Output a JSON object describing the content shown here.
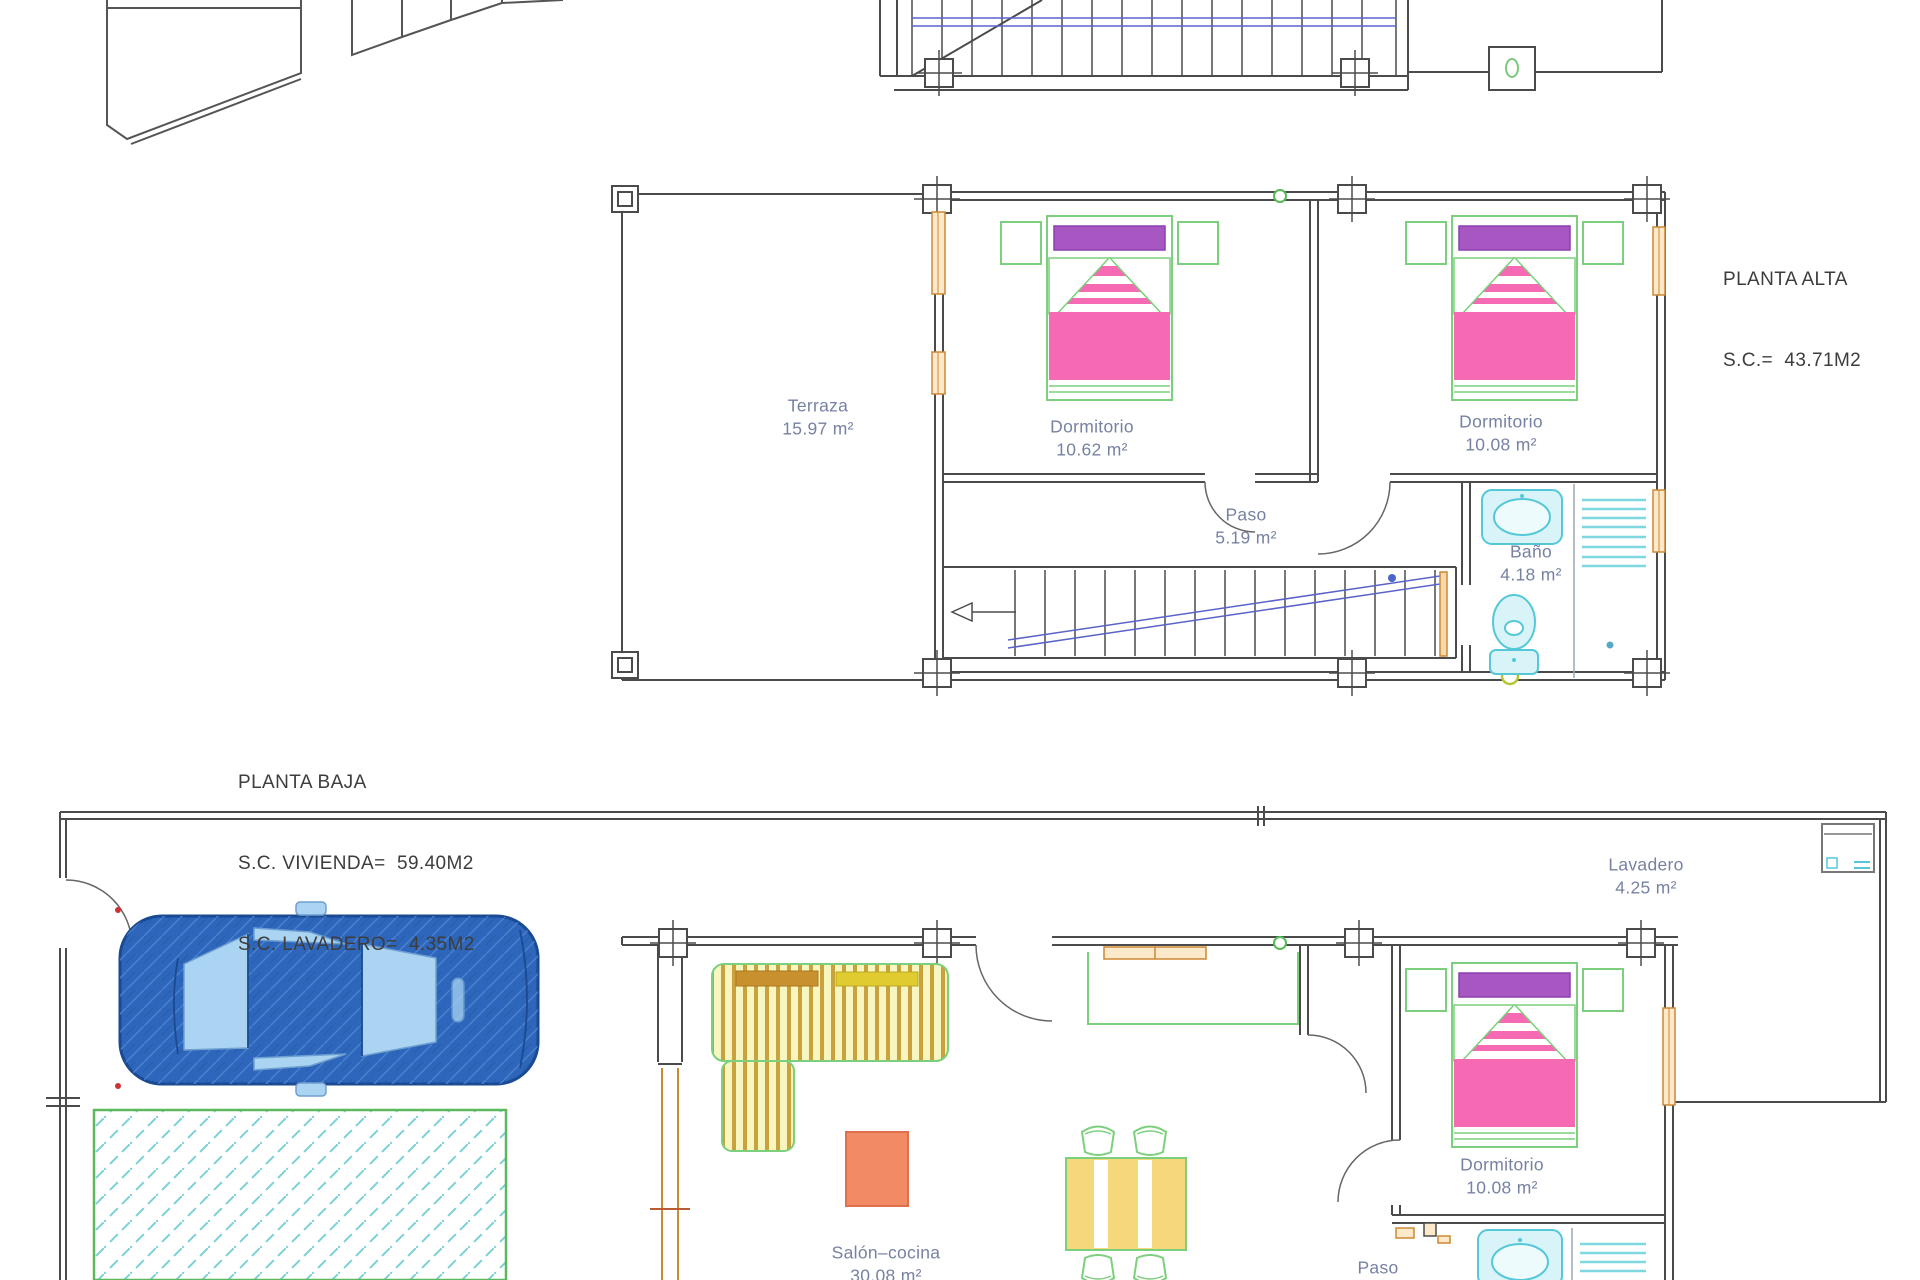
{
  "document": {
    "type": "architectural floor plan"
  },
  "colors": {
    "wall": "#4b4b4b",
    "furniture_green": "#7ccf7c",
    "bed_pink": "#f56ab2",
    "pillow_purple": "#a757c1",
    "bath_cyan": "#55c8d8",
    "window_orange": "#cc8833",
    "car_blue": "#2d66ba",
    "label_blue_gray": "#7782a3",
    "stair_blue": "#5a63c8",
    "table_yellow": "#f6d87c",
    "coffee_table_orange": "#f28a66"
  },
  "planta_alta": {
    "title": "PLANTA ALTA",
    "area_line": "S.C.=  43.71M2",
    "rooms": {
      "terraza": {
        "name": "Terraza",
        "area": "15.97 m²"
      },
      "dormitorio1": {
        "name": "Dormitorio",
        "area": "10.62 m²"
      },
      "dormitorio2": {
        "name": "Dormitorio",
        "area": "10.08 m²"
      },
      "paso": {
        "name": "Paso",
        "area": "5.19 m²"
      },
      "bano": {
        "name": "Baño",
        "area": "4.18 m²"
      }
    }
  },
  "planta_baja": {
    "title": "PLANTA BAJA",
    "vivienda_line": "S.C. VIVIENDA=  59.40M2",
    "lavadero_line": "S.C. LAVADERO=  4.35M2",
    "rooms": {
      "lavadero": {
        "name": "Lavadero",
        "area": "4.25 m²"
      },
      "salon_cocina": {
        "name": "Salón–cocina",
        "area": "30.08 m²"
      },
      "dormitorio": {
        "name": "Dormitorio",
        "area": "10.08 m²"
      },
      "paso": {
        "name": "Paso"
      }
    }
  }
}
